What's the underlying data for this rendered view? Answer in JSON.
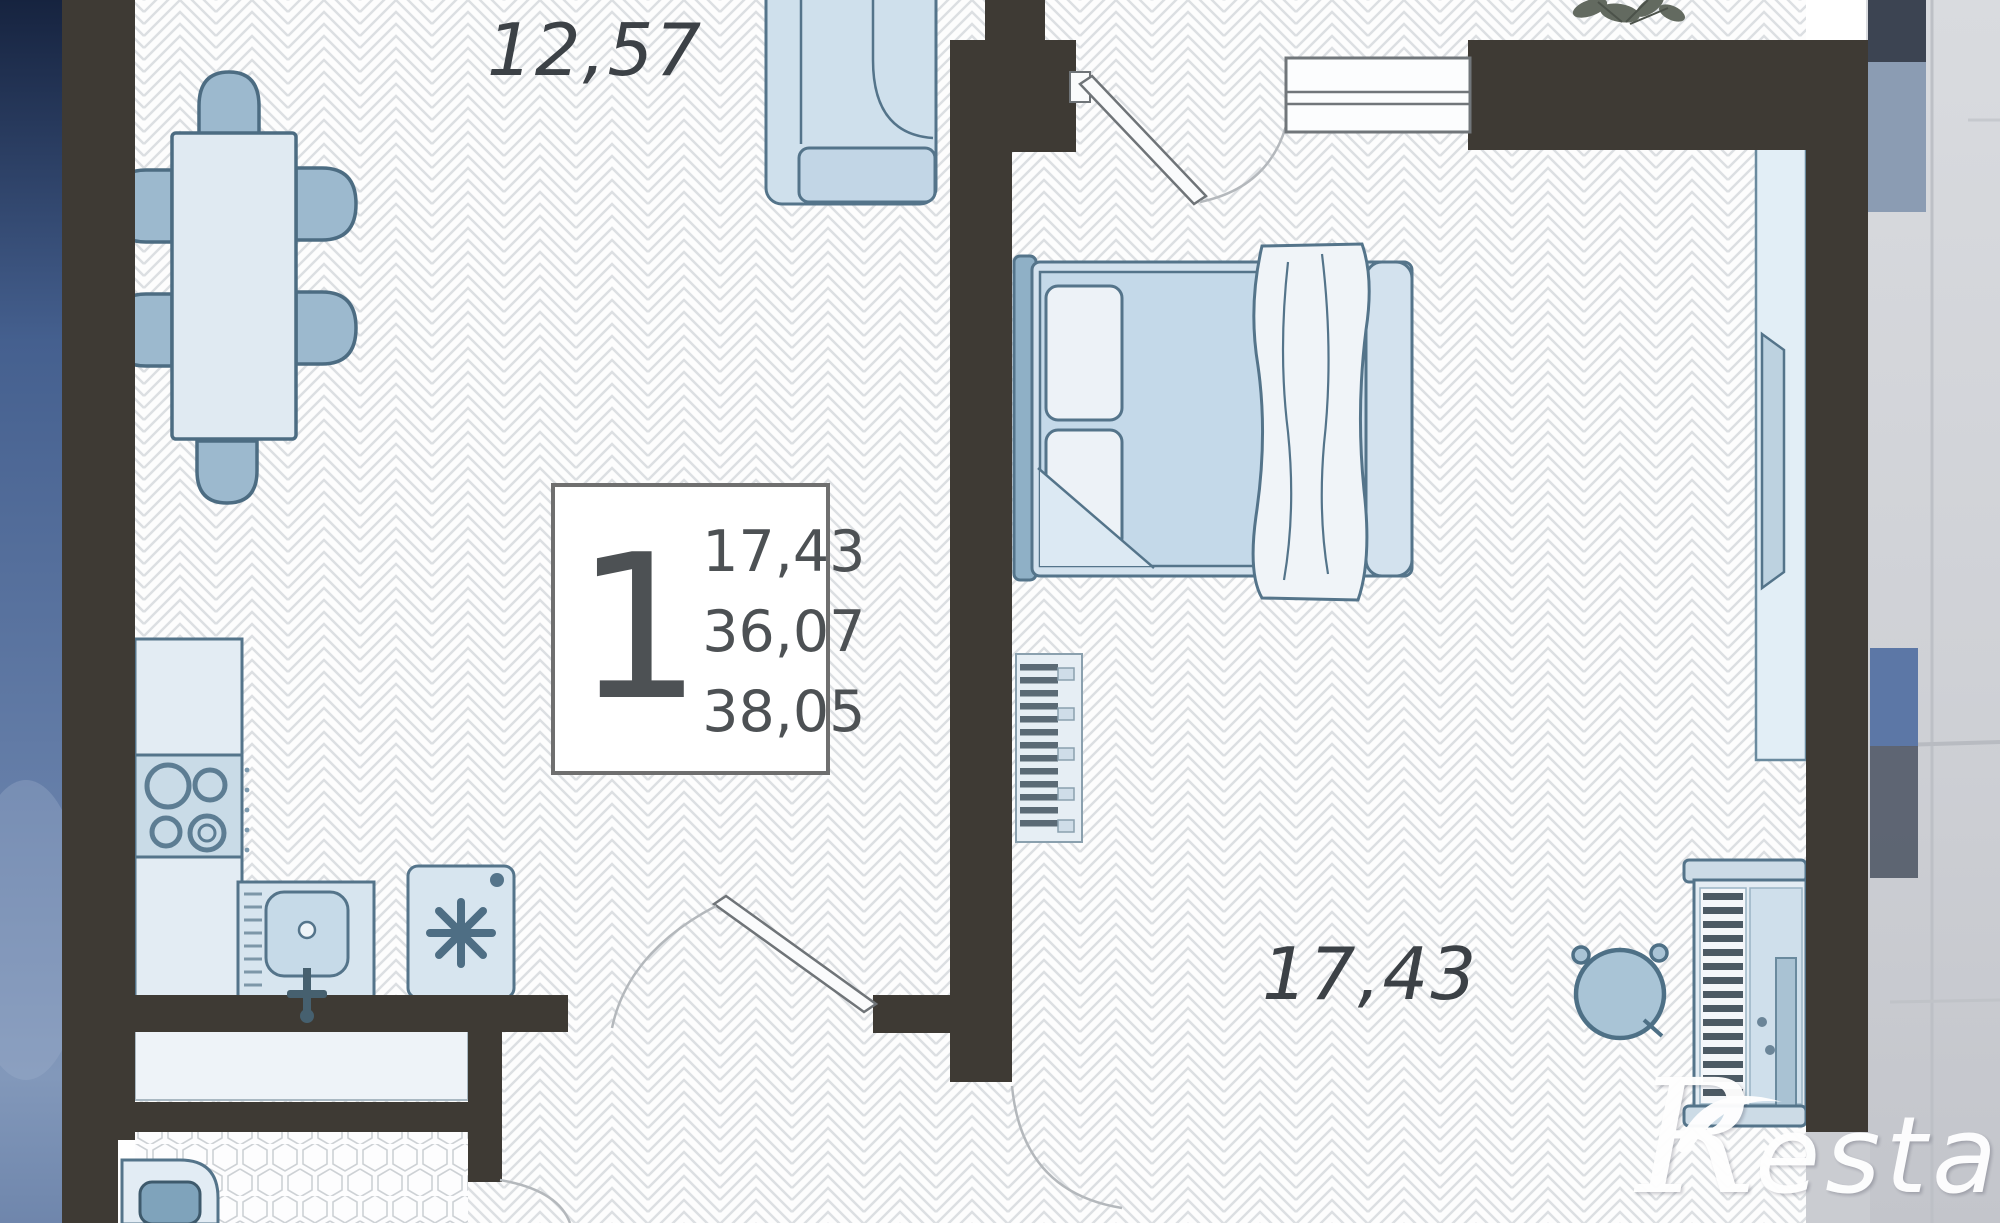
{
  "floor_plan": {
    "labels": {
      "living_area": "12,57",
      "bedroom_area": "17,43"
    },
    "info_box": {
      "rooms_count": "1",
      "values": [
        "17,43",
        "36,07",
        "38,05"
      ]
    },
    "watermark": {
      "initial": "R",
      "rest": "estate"
    },
    "colors": {
      "wall": "#3e3a34",
      "furniture_stroke": "#54748a",
      "furniture_fill": "#d7e4ef",
      "chair_fill": "#9cb9ce",
      "sky": "#5a74a0",
      "facade": "#d6d8dc"
    }
  }
}
